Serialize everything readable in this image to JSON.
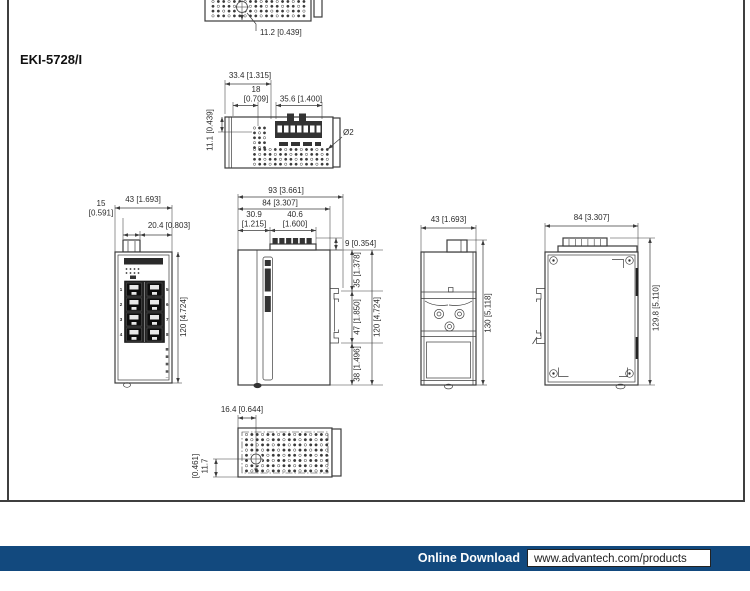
{
  "title": "EKI-5728/I",
  "footer": {
    "label": "Online Download",
    "url": "www.advantech.com/products",
    "bar_color": "#12497e"
  },
  "views": {
    "prev_bottom": {
      "hole_offset": "11.2 [0.439]"
    },
    "top": {
      "width_left": "33.4 [1.315]",
      "offset": "18",
      "offset_in": "[0.709]",
      "terminal_width": "35.6 [1.400]",
      "hole_top": "11.1 [0.439]",
      "hole_dia": "Ø2"
    },
    "front": {
      "conn_width": "15",
      "conn_width_in": "[0.591]",
      "body_width": "43 [1.693]",
      "conn_offset": "20.4 [0.803]",
      "body_height": "120 [4.724]",
      "ports_left": [
        "1",
        "2",
        "3",
        "4"
      ],
      "ports_right": [
        "5",
        "6",
        "7",
        "8"
      ]
    },
    "side": {
      "depth_total": "93 [3.661]",
      "depth_body": "84 [3.307]",
      "front_depth": "30.9",
      "front_depth_in": "[1.215]",
      "terminal_depth": "40.6",
      "terminal_depth_in": "[1.600]",
      "terminal_height": "9 [0.354]",
      "top_span": "35 [1.378]",
      "clip_span": "47 [1.850]",
      "bottom_span": "38 [1.496]",
      "body_height": "120 [4.724]"
    },
    "rear": {
      "body_width": "43 [1.693]",
      "total_height": "130 [5.118]"
    },
    "right": {
      "depth_body": "84 [3.307]",
      "total_height": "129.8 [5.110]"
    },
    "bottom": {
      "hole_offset_x": "16.4 [0.644]",
      "hole_offset_y": "11.7",
      "hole_offset_y_in": "[0.461]"
    }
  }
}
